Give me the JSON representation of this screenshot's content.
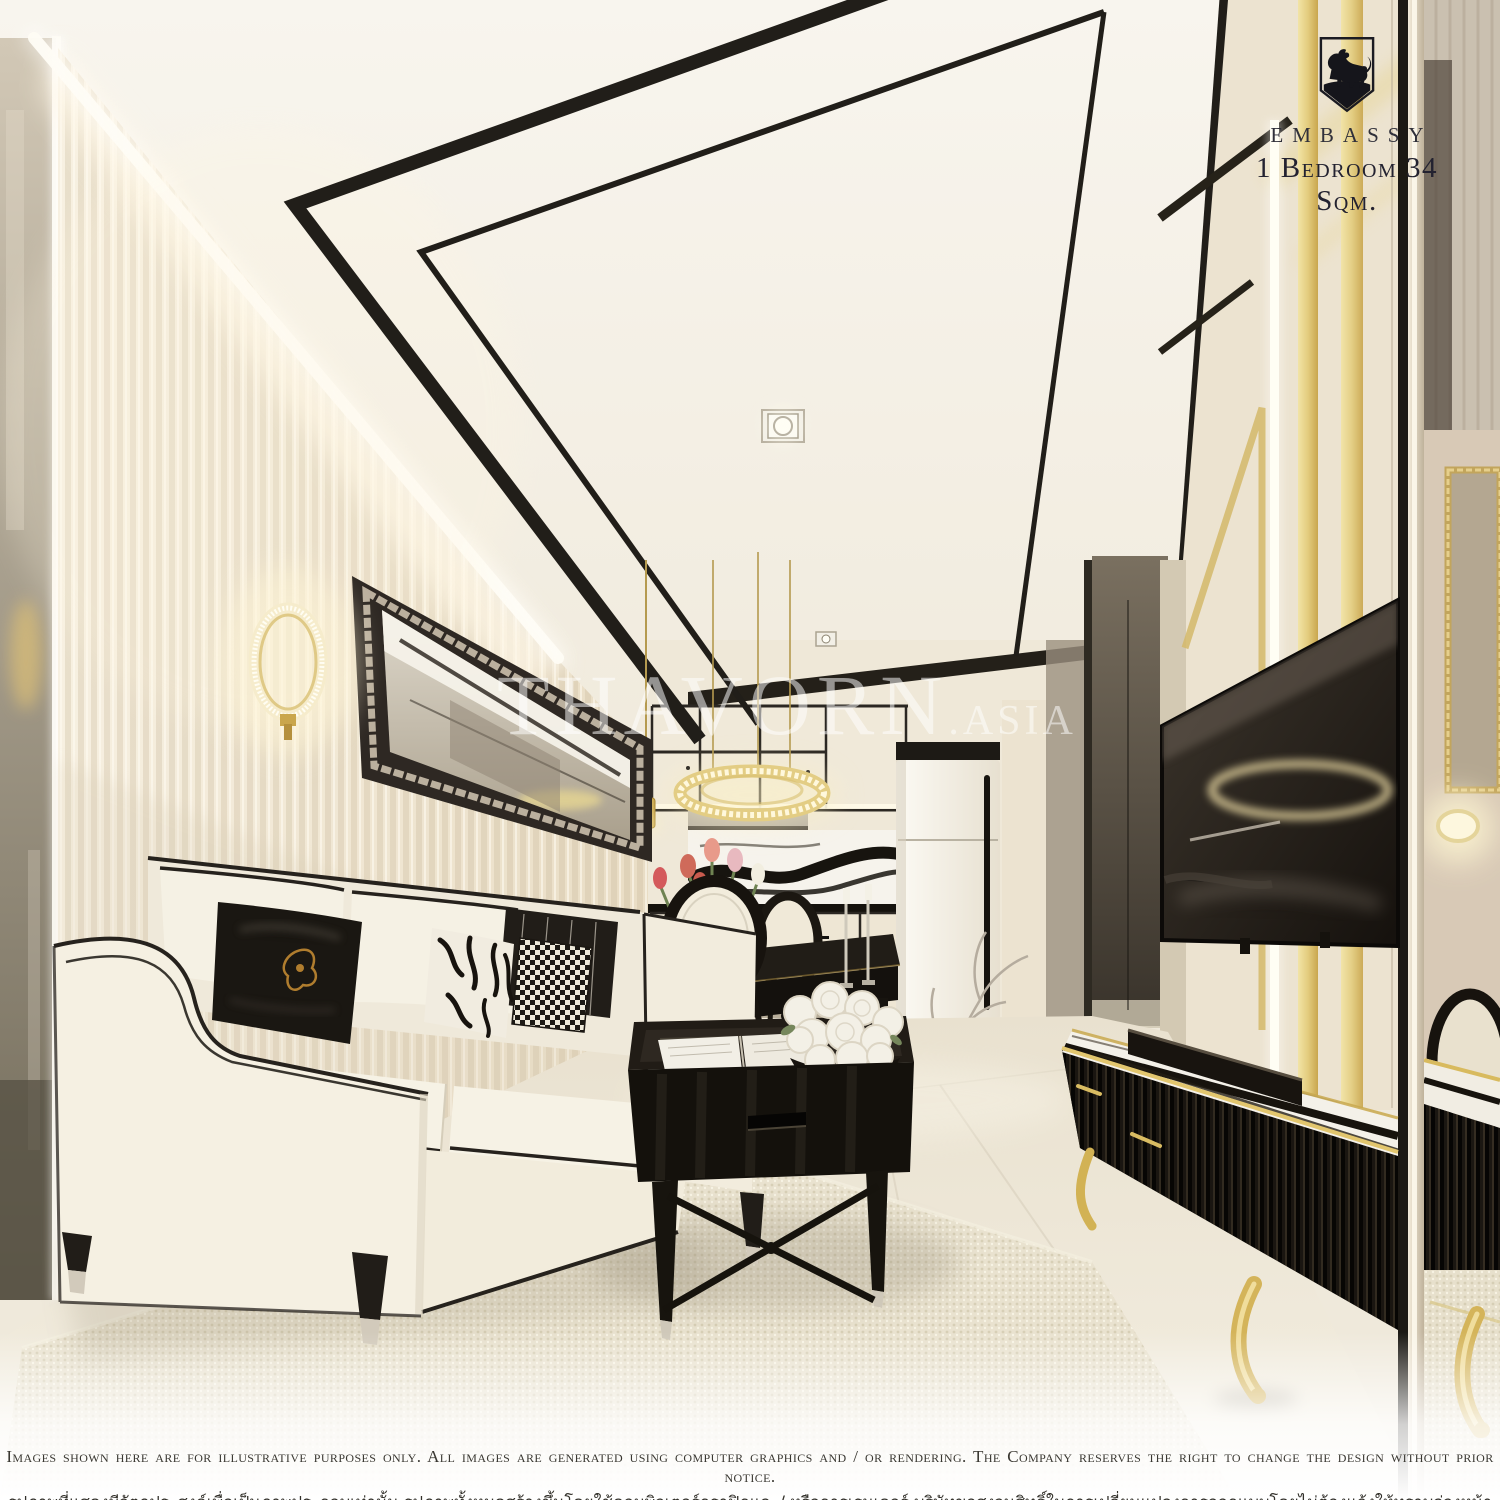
{
  "page": {
    "title": "Embassy 1 Bedroom 34 Sqm. interior render"
  },
  "branding": {
    "logo_icon": "lion-crest",
    "logo_name": "EMBASSY",
    "unit_label": "1 Bedroom 34 Sqm."
  },
  "watermark": {
    "main": "THAVORN",
    "suffix": ".ASIA"
  },
  "disclaimer": {
    "line1_en": "Images shown here are for illustrative purposes only. All images are generated using computer graphics and / or rendering. The Company reserves the right to change the design without prior notice.",
    "line2_th": "รูปภาพที่แสดงมีวัตถุประสงค์เพื่อเป็นภาพประกอบเท่านั้น รูปภาพทั้งหมดสร้างขึ้นโดยใช้คอมพิวเตอร์กราฟิกและ/ หรือการเรนเดอร์ บริษัทขอสงวนสิทธิ์ในการเปลี่ยนแปลงการออกแบบโดยไม่ต้องแจ้งให้ทราบล่วงหน้า"
  },
  "colors": {
    "ceiling": "#f6f3ea",
    "trim_black": "#211e19",
    "wall_cream": "#f1e9d7",
    "gold": "#d8bf72",
    "sofa_cream": "#f4efe2",
    "floor": "#ece5d4",
    "watermark_white": "#ffffff",
    "logo_dark": "#23222b"
  }
}
